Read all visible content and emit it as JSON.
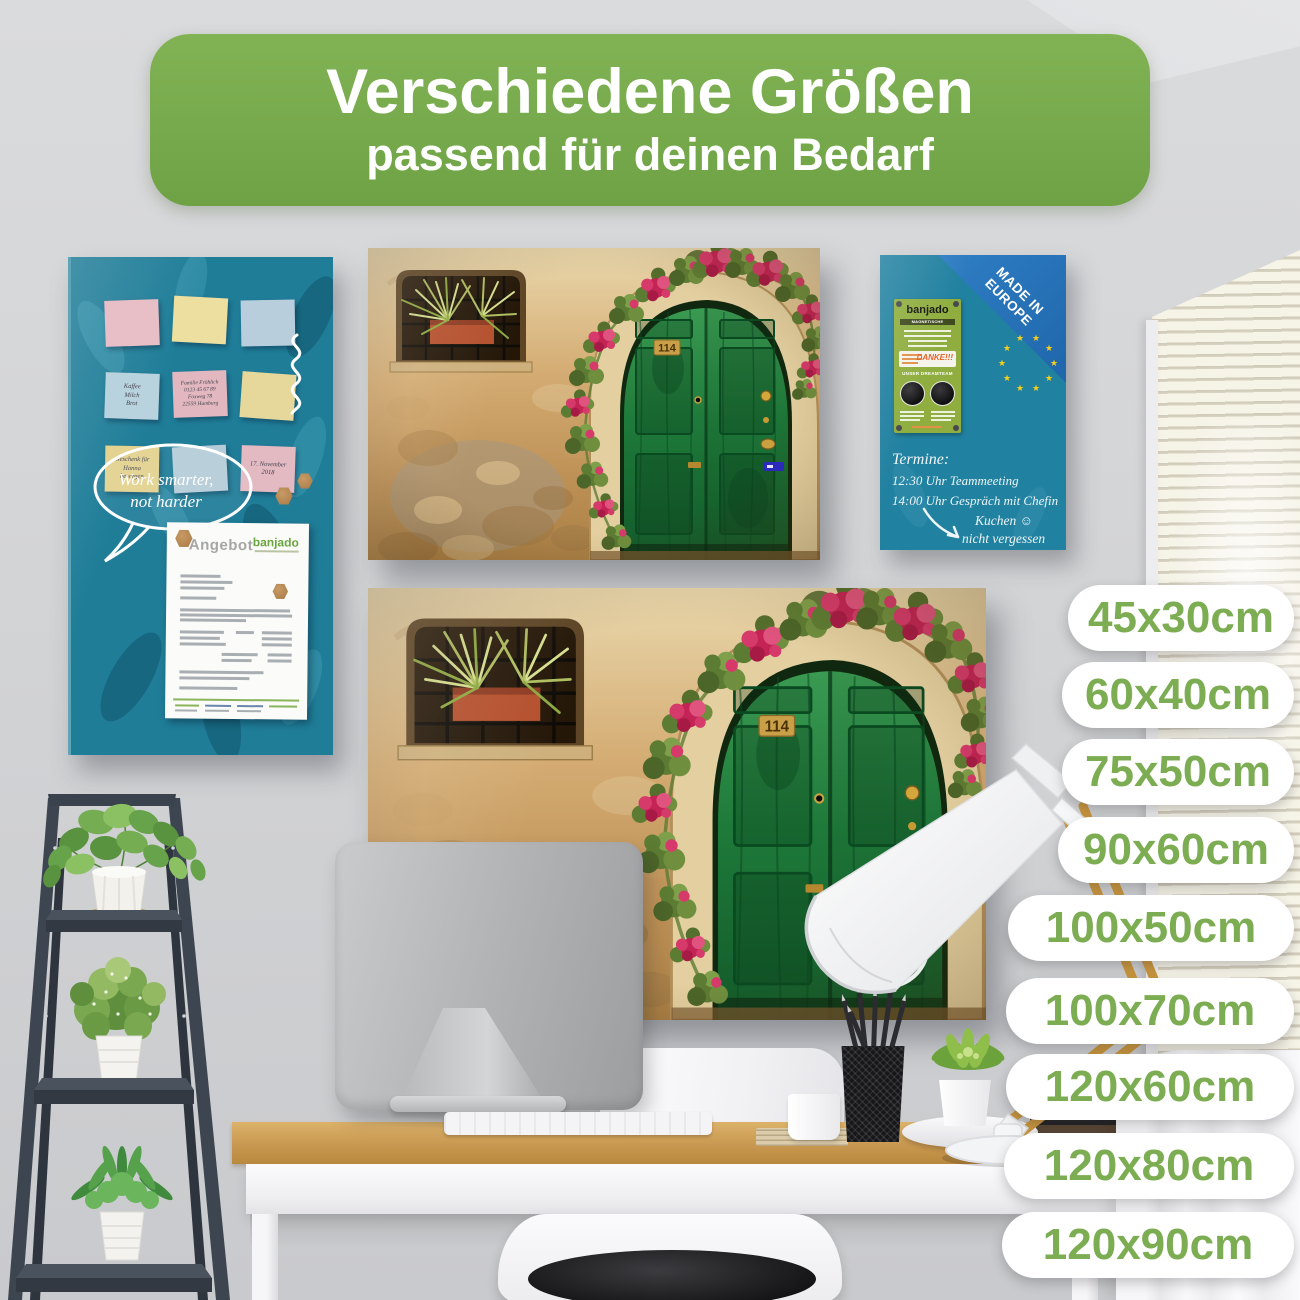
{
  "header": {
    "title": "Verschiedene Größen",
    "subtitle": "passend für deinen Bedarf"
  },
  "sizes": [
    "45x30cm",
    "60x40cm",
    "75x50cm",
    "90x60cm",
    "100x50cm",
    "100x70cm",
    "120x60cm",
    "120x80cm",
    "120x90cm"
  ],
  "teal_board": {
    "notes": [
      {
        "color": "pink",
        "text": ""
      },
      {
        "color": "yellow",
        "text": ""
      },
      {
        "color": "blue",
        "text": ""
      },
      {
        "color": "blue",
        "text": "Kaffee\nMilch\nBrot"
      },
      {
        "color": "pink",
        "text": "Familie Fröhlich\n0123 45 67 89\nFoxweg 78\n22559 Hamburg"
      },
      {
        "color": "yellow",
        "text": ""
      },
      {
        "color": "yellow",
        "text": "Geschenk für\nHanna\nbesorgen"
      },
      {
        "color": "blue",
        "text": ""
      },
      {
        "color": "pink",
        "text": "17. November\n2018"
      }
    ],
    "speech_bubble": "Work smarter,\nnot harder",
    "document": {
      "title": "Angebot",
      "brand": "banjado"
    }
  },
  "blue_board": {
    "ribbon_line1": "MADE IN",
    "ribbon_line2": "EUROPE",
    "label": {
      "brand": "banjado",
      "subtitle": "MAGNETISCHE MEMOBOARDS",
      "thanks": "DANKE!!!",
      "team": "UNSER DREAMTEAM"
    },
    "schedule": {
      "heading": "Termine:",
      "line1": "12:30 Uhr Teammeeting",
      "line2": "14:00 Uhr Gespräch mit Chefin",
      "note1": "Kuchen",
      "smiley": "☺",
      "note2": "nicht vergessen"
    }
  },
  "door_board": {
    "house_number": "114"
  },
  "colors": {
    "banner_green": "#74a845",
    "pill_text_green": "#7cad52",
    "board_teal": "#1f7d98",
    "ribbon_blue": "#2472b8",
    "label_green": "#8fae3f",
    "door_green": "#1d7036",
    "wall_tan": "#c9a06a"
  }
}
